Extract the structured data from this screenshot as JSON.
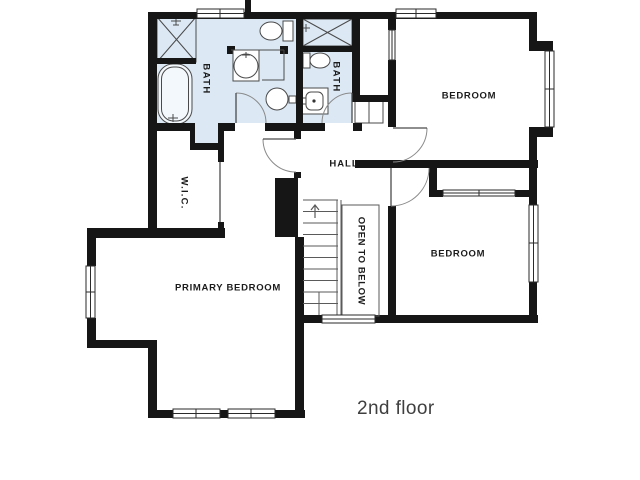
{
  "page": {
    "background": "#ffffff",
    "width": 640,
    "height": 480
  },
  "plan": {
    "floor_label": {
      "text": "2nd floor",
      "x": 394,
      "y": 411,
      "size": 19
    },
    "colors": {
      "wall": "#161616",
      "bath_fill": "#dce9f5",
      "fixture_stroke": "#4a4a4a",
      "fixture_fill": "#ffffff",
      "door_arc": "#8a8a8a",
      "thin_line": "#5a5a5a",
      "window_border": "#2a2a2a",
      "label_color": "#1c1c1c",
      "caption_color": "#3f3f3f"
    },
    "labels": [
      {
        "name": "bath-1",
        "text": "BATH",
        "x": 206,
        "y": 79,
        "rotate": true,
        "size": 9.5,
        "ls": 1.4
      },
      {
        "name": "bath-2",
        "text": "BATH",
        "x": 336,
        "y": 77,
        "rotate": true,
        "size": 9.5,
        "ls": 1.4
      },
      {
        "name": "wic",
        "text": "W.I.C.",
        "x": 184,
        "y": 193,
        "rotate": true,
        "size": 9.5,
        "ls": 1.2
      },
      {
        "name": "hall",
        "text": "HALL",
        "x": 344,
        "y": 164,
        "rotate": false,
        "size": 9.5,
        "ls": 1.0
      },
      {
        "name": "open-to-below",
        "text": "OPEN TO BELOW",
        "x": 361,
        "y": 261,
        "rotate": true,
        "size": 9.5,
        "ls": 0.6
      },
      {
        "name": "bedroom-1",
        "text": "BEDROOM",
        "x": 469,
        "y": 96,
        "rotate": false,
        "size": 9.5,
        "ls": 0.7
      },
      {
        "name": "bedroom-2",
        "text": "BEDROOM",
        "x": 458,
        "y": 254,
        "rotate": false,
        "size": 9.5,
        "ls": 0.7
      },
      {
        "name": "primary-bedroom",
        "text": "PRIMARY BEDROOM",
        "x": 228,
        "y": 288,
        "rotate": false,
        "size": 9.5,
        "ls": 0.7
      }
    ],
    "bath_fills": [
      {
        "name": "bath-1-floor",
        "r": [
          157,
          19,
          139,
          104
        ]
      },
      {
        "name": "bath-1-alcove",
        "r": [
          195,
          123,
          23,
          22
        ]
      },
      {
        "name": "bath-2-floor",
        "r": [
          303,
          19,
          49,
          104
        ]
      }
    ],
    "walls": [
      [
        148,
        12,
        389,
        7
      ],
      [
        245,
        0,
        6,
        13
      ],
      [
        148,
        12,
        9,
        119
      ],
      [
        150,
        58,
        46,
        6
      ],
      [
        296,
        19,
        7,
        112
      ],
      [
        352,
        19,
        8,
        82
      ],
      [
        352,
        95,
        38,
        7
      ],
      [
        388,
        19,
        8,
        11
      ],
      [
        388,
        60,
        8,
        67
      ],
      [
        148,
        123,
        47,
        8
      ],
      [
        190,
        123,
        5,
        27
      ],
      [
        190,
        143,
        32,
        7
      ],
      [
        218,
        123,
        6,
        39
      ],
      [
        224,
        123,
        11,
        8
      ],
      [
        265,
        123,
        36,
        8
      ],
      [
        301,
        123,
        24,
        8
      ],
      [
        353,
        123,
        9,
        8
      ],
      [
        294,
        131,
        7,
        8
      ],
      [
        294,
        172,
        7,
        6
      ],
      [
        275,
        178,
        23,
        59
      ],
      [
        218,
        222,
        6,
        16
      ],
      [
        148,
        131,
        9,
        107
      ],
      [
        87,
        228,
        138,
        10
      ],
      [
        87,
        228,
        9,
        38
      ],
      [
        87,
        318,
        9,
        30
      ],
      [
        87,
        340,
        70,
        8
      ],
      [
        148,
        340,
        9,
        78
      ],
      [
        148,
        410,
        157,
        8
      ],
      [
        295,
        237,
        9,
        181
      ],
      [
        295,
        315,
        27,
        8
      ],
      [
        375,
        315,
        163,
        8
      ],
      [
        529,
        12,
        8,
        31
      ],
      [
        529,
        41,
        24,
        10
      ],
      [
        529,
        127,
        24,
        10
      ],
      [
        529,
        137,
        8,
        31
      ],
      [
        355,
        160,
        183,
        8
      ],
      [
        529,
        168,
        8,
        37
      ],
      [
        529,
        282,
        8,
        41
      ],
      [
        429,
        168,
        8,
        29
      ],
      [
        429,
        190,
        14,
        7
      ],
      [
        515,
        190,
        14,
        7
      ],
      [
        388,
        206,
        8,
        111
      ]
    ],
    "windows": [
      {
        "name": "window-bath-top",
        "r": [
          197,
          9,
          47,
          9
        ],
        "center": [
          197,
          13.5,
          244,
          13.5
        ],
        "tick": [
          220,
          9,
          220,
          18
        ]
      },
      {
        "name": "window-bedroom1-top",
        "r": [
          396,
          9,
          40,
          9
        ],
        "center": [
          396,
          13.5,
          436,
          13.5
        ],
        "tick": [
          416,
          9,
          416,
          18
        ]
      },
      {
        "name": "window-primary-left",
        "r": [
          86,
          266,
          9,
          52
        ],
        "center": [
          90.5,
          266,
          90.5,
          318
        ],
        "tick": [
          86,
          292,
          95,
          292
        ]
      },
      {
        "name": "window-primary-bot-1",
        "r": [
          173,
          409,
          47,
          9
        ],
        "center": [
          173,
          413.5,
          220,
          413.5
        ],
        "tick": [
          196,
          409,
          196,
          418
        ]
      },
      {
        "name": "window-primary-bot-2",
        "r": [
          228,
          409,
          47,
          9
        ],
        "center": [
          228,
          413.5,
          275,
          413.5
        ],
        "tick": [
          251,
          409,
          251,
          418
        ]
      },
      {
        "name": "window-bedroom1-right",
        "r": [
          545,
          51,
          9,
          76
        ],
        "center": [
          549.5,
          51,
          549.5,
          127
        ],
        "tick": [
          545,
          89,
          554,
          89
        ]
      },
      {
        "name": "window-bedroom2-right",
        "r": [
          529,
          205,
          9,
          77
        ],
        "center": [
          533.5,
          205,
          533.5,
          282
        ],
        "tick": [
          529,
          243,
          538,
          243
        ]
      },
      {
        "name": "window-landing",
        "r": [
          322,
          315,
          53,
          8
        ],
        "center": [
          322,
          319,
          375,
          319
        ],
        "tick": null
      },
      {
        "name": "window-bedroom1-left",
        "r": [
          389,
          30,
          6,
          30
        ],
        "center": [
          392,
          30,
          392,
          60
        ],
        "tick": null
      },
      {
        "name": "closet-slider",
        "r": [
          443,
          190,
          72,
          6
        ],
        "center": [
          443,
          193,
          515,
          193
        ],
        "tick": [
          479,
          190,
          479,
          196
        ]
      }
    ],
    "doors": [
      {
        "name": "door-bath-1",
        "leaf": [
          236,
          93,
          236,
          123
        ],
        "arc": "M236,93 A30,30 0 0 1 266,123"
      },
      {
        "name": "door-bath-2",
        "leaf": [
          352,
          93,
          352,
          123
        ],
        "arc": "M352,93 A30,30 0 0 0 322,123"
      },
      {
        "name": "door-hall",
        "leaf": [
          263,
          139,
          296,
          139
        ],
        "arc": "M263,139 A33,33 0 0 0 296,172"
      },
      {
        "name": "door-bedroom-1",
        "leaf": [
          393,
          128,
          427,
          128
        ],
        "arc": "M427,128 A34,34 0 0 1 393,162"
      },
      {
        "name": "door-bedroom-2",
        "leaf": [
          391,
          168,
          391,
          206
        ],
        "arc": "M429,168 A38,38 0 0 1 391,206"
      },
      {
        "name": "door-wic",
        "leaf": [
          220,
          162,
          220,
          222
        ],
        "arc": null
      }
    ],
    "stairs": {
      "tread_x1": 303,
      "tread_x2": 338,
      "tread_ys": [
        200,
        211.5,
        223,
        234.5,
        246,
        257.5,
        269,
        280.5,
        292,
        303.5
      ],
      "winder": [
        319,
        292,
        319,
        315
      ],
      "rails": [
        [
          337,
          200,
          337,
          315
        ],
        [
          341,
          200,
          341,
          315
        ]
      ],
      "arrow": "M315,218 L315,206 M311,210 L315,205 L319,210",
      "open_below_rect": [
        342,
        205,
        37,
        111
      ]
    },
    "fixtures": [
      {
        "t": "rect",
        "n": "shower-1",
        "x": 157,
        "y": 17,
        "w": 39,
        "h": 45,
        "f": "none"
      },
      {
        "t": "x",
        "n": "shower-1-glass",
        "x": 157,
        "y": 17,
        "w": 39,
        "h": 45
      },
      {
        "t": "path",
        "n": "shower-1-head",
        "d": "M171,21 h10 M176,17 v8 M173,25 h6"
      },
      {
        "t": "rrect",
        "n": "bathtub",
        "x": 158,
        "y": 64,
        "w": 34,
        "h": 60,
        "rx": 15,
        "f": "#f3f8fc"
      },
      {
        "t": "rrect",
        "n": "bathtub-inner",
        "x": 161.5,
        "y": 67,
        "w": 27,
        "h": 54,
        "rx": 12,
        "f": "none"
      },
      {
        "t": "path",
        "n": "bathtub-faucet",
        "d": "M168,118 h10 M173,114 v8"
      },
      {
        "t": "ellipse",
        "n": "toilet-1-bowl",
        "cx": 271,
        "cy": 31,
        "rx": 11,
        "ry": 9,
        "f": "#ffffff"
      },
      {
        "t": "rect",
        "n": "toilet-1-tank",
        "x": 283,
        "y": 21,
        "w": 10,
        "h": 20,
        "f": "#ffffff"
      },
      {
        "t": "rect",
        "n": "vanity-1-cap-l",
        "x": 227,
        "y": 46,
        "w": 8,
        "h": 8,
        "f": "#161616",
        "s": "none"
      },
      {
        "t": "rect",
        "n": "vanity-1-cap-r",
        "x": 280,
        "y": 46,
        "w": 8,
        "h": 8,
        "f": "#161616",
        "s": "none"
      },
      {
        "t": "line",
        "n": "vanity-1-counter",
        "x1": 231,
        "y1": 50,
        "x2": 284,
        "y2": 50
      },
      {
        "t": "rect",
        "n": "vanity-1-box",
        "x": 233,
        "y": 50,
        "w": 26,
        "h": 31,
        "f": "#ffffff"
      },
      {
        "t": "circle",
        "n": "sink-1",
        "cx": 246,
        "cy": 66,
        "r": 12,
        "f": "#ffffff"
      },
      {
        "t": "path",
        "n": "sink-1-faucet",
        "d": "M246,52 v6 M242,55 h8"
      },
      {
        "t": "path",
        "n": "counter-edge",
        "d": "M284,50 V80 H262"
      },
      {
        "t": "circle",
        "n": "sink-2",
        "cx": 277,
        "cy": 99,
        "r": 11,
        "f": "#ffffff"
      },
      {
        "t": "rect",
        "n": "sink-2-faucet",
        "x": 289,
        "y": 96,
        "w": 7,
        "h": 7,
        "f": "#ffffff"
      },
      {
        "t": "rect",
        "n": "shower-2",
        "x": 303,
        "y": 19,
        "w": 49,
        "h": 27,
        "f": "none"
      },
      {
        "t": "x",
        "n": "shower-2-glass",
        "x": 303,
        "y": 19,
        "w": 49,
        "h": 27
      },
      {
        "t": "rect",
        "n": "shower-2-sill",
        "x": 300,
        "y": 46,
        "w": 52,
        "h": 6,
        "f": "#161616",
        "s": "none"
      },
      {
        "t": "path",
        "n": "shower-2-head",
        "d": "M302,28 h8 M306,24 v8"
      },
      {
        "t": "rect",
        "n": "toilet-2-tank",
        "x": 303,
        "y": 53,
        "w": 7,
        "h": 15,
        "f": "#ffffff"
      },
      {
        "t": "ellipse",
        "n": "toilet-2-bowl",
        "cx": 320,
        "cy": 60.5,
        "rx": 10,
        "ry": 7.5,
        "f": "#ffffff"
      },
      {
        "t": "rect",
        "n": "vanity-2",
        "x": 302,
        "y": 88,
        "w": 26,
        "h": 26,
        "f": "#ffffff"
      },
      {
        "t": "rrect",
        "n": "vanity-2-basin",
        "x": 306,
        "y": 92,
        "w": 17,
        "h": 18,
        "rx": 5,
        "f": "none"
      },
      {
        "t": "circle",
        "n": "vanity-2-drain",
        "cx": 314,
        "cy": 101,
        "r": 1.6,
        "f": "#333333",
        "s": "none"
      },
      {
        "t": "rect",
        "n": "vanity-2-faucet",
        "x": 302,
        "y": 98,
        "w": 4,
        "h": 6,
        "f": "#ffffff"
      },
      {
        "t": "rect",
        "n": "linen-shelf",
        "x": 355,
        "y": 101,
        "w": 28,
        "h": 22,
        "f": "#ffffff"
      },
      {
        "t": "line",
        "n": "linen-shelf-divider",
        "x1": 369,
        "y1": 101,
        "x2": 369,
        "y2": 123
      }
    ]
  }
}
